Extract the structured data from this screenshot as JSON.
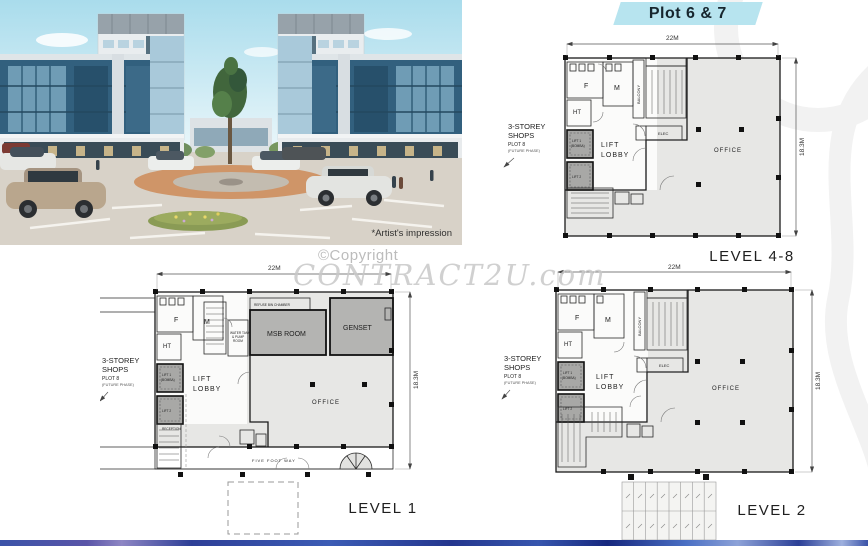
{
  "banner": {
    "label": "Plot 6 & 7"
  },
  "rendering": {
    "caption": "*Artist's impression"
  },
  "watermark": {
    "line1": "©Copyright",
    "line2": "CONTRACT2U.com"
  },
  "plans": {
    "level48": {
      "title": "LEVEL 4-8",
      "dim_width": "22M",
      "dim_height": "18.3M",
      "side1": "3-STOREY",
      "side2": "SHOPS",
      "side3": "PLOT 8",
      "side4": "(FUTURE PHASE)",
      "f": "F",
      "m": "M",
      "ht": "HT",
      "balcony": "BALCONY",
      "lift1": "LIFT 1",
      "lift1_sub": "(BOMBA)",
      "lift2": "LIFT 2",
      "lobby1": "LIFT",
      "lobby2": "LOBBY",
      "office": "OFFICE",
      "elec": "ELEC"
    },
    "level1": {
      "title": "LEVEL 1",
      "dim_width": "22M",
      "dim_height": "18.3M",
      "side1": "3-STOREY",
      "side2": "SHOPS",
      "side3": "PLOT 8",
      "side4": "(FUTURE PHASE)",
      "f": "F",
      "m": "M",
      "ht": "HT",
      "lift1": "LIFT 1",
      "lift1_sub": "(BOMBA)",
      "lift2": "LIFT 2",
      "lobby1": "LIFT",
      "lobby2": "LOBBY",
      "office": "OFFICE",
      "refuse": "REFUSE BIN CHAMBER",
      "msb": "MSB ROOM",
      "genset": "GENSET",
      "water1": "WATER TANK",
      "water2": "& PUMP",
      "water3": "ROOM",
      "reception": "RECEPTION",
      "five_foot_way": "FIVE FOOT WAY"
    },
    "level2": {
      "title": "LEVEL 2",
      "dim_width": "22M",
      "dim_height": "18.3M",
      "side1": "3-STOREY",
      "side2": "SHOPS",
      "side3": "PLOT 8",
      "side4": "(FUTURE PHASE)",
      "f": "F",
      "m": "M",
      "ht": "HT",
      "balcony": "BALCONY",
      "lift1": "LIFT 1",
      "lift1_sub": "(BOMBA)",
      "lift2": "LIFT 2",
      "lobby1": "LIFT",
      "lobby2": "LOBBY",
      "office": "OFFICE",
      "elec": "ELEC"
    }
  },
  "colors": {
    "banner_bg": "#b7e4ef",
    "building_blue": "#32607e",
    "roundabout_orange": "#cf9568",
    "plan_floor": "#e7e7e5",
    "watermark_gray": "#c8c8c8",
    "footer_blue": "#2c3f97"
  }
}
